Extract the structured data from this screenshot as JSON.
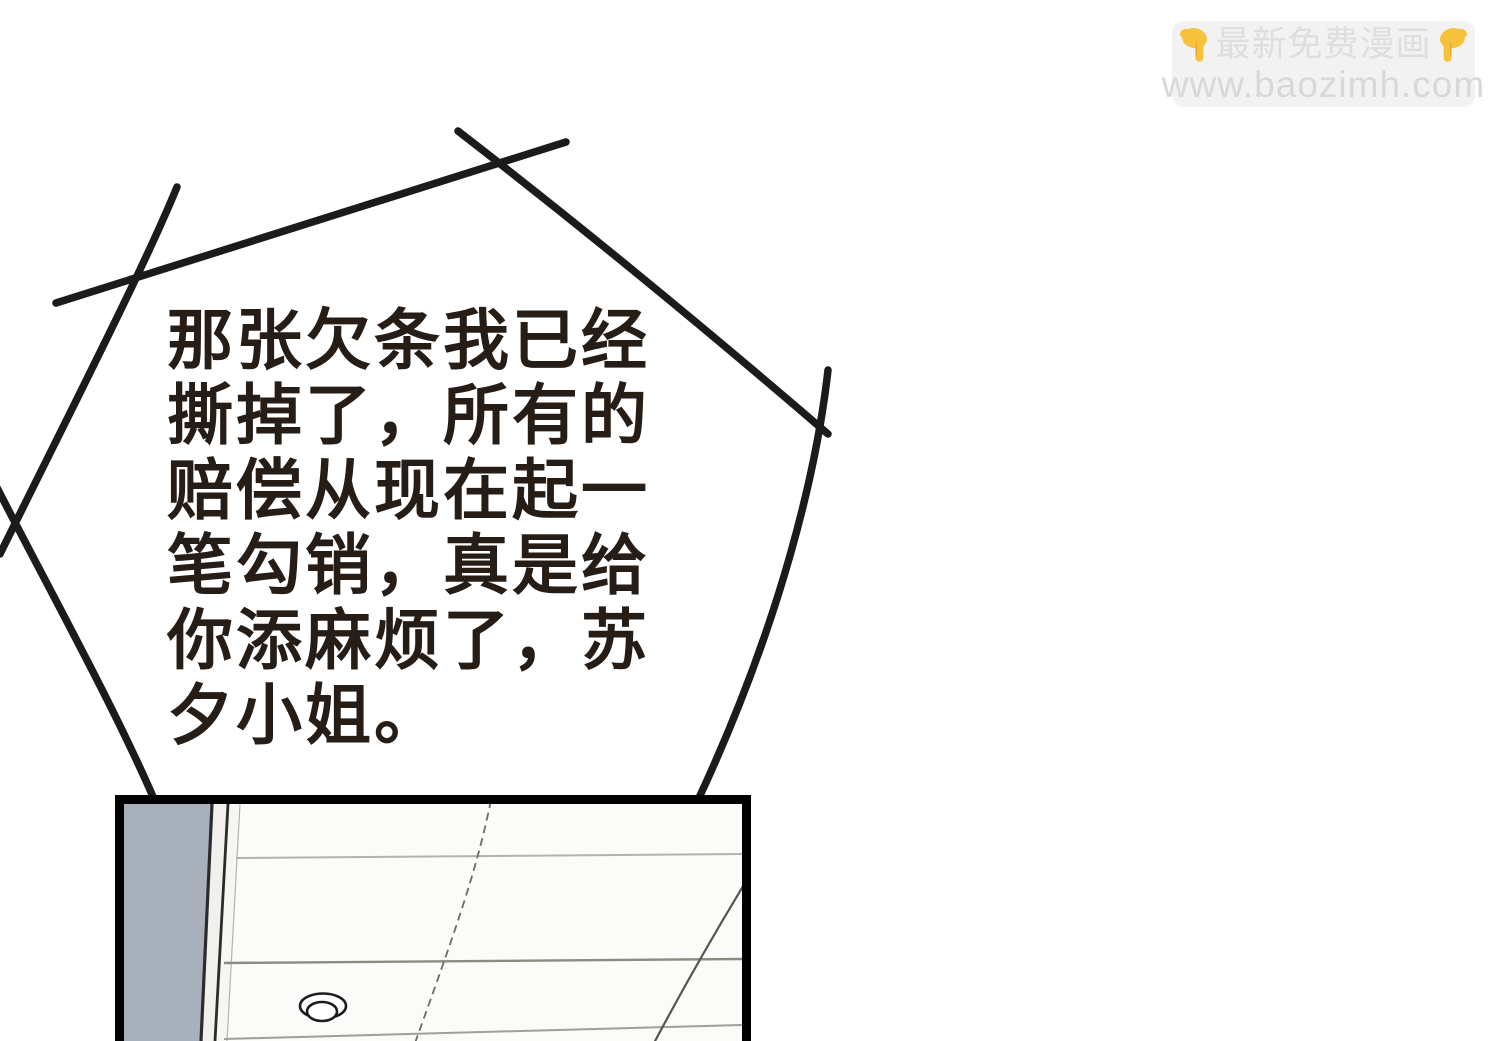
{
  "colors": {
    "page_bg": "#ffffff",
    "ink": "#1b1b1b",
    "speech_text": "#261d17",
    "watermark_bg": "#f2f2f2",
    "watermark_text": "#dedede",
    "watermark_url": "#d8d8d8",
    "hand_yellow": "#f6c23c",
    "hand_shade": "#dd9e2e",
    "wall_gray": "#a8b0bb",
    "trim_white": "#f1f0ec",
    "ceiling_white": "#fbfbfa",
    "seam_light": "#b2b2ae",
    "seam_dark": "#8b8b82",
    "panel_border": "#000000"
  },
  "watermark": {
    "title": "最新免费漫画",
    "url": "www.baozimh.com",
    "left_icon": "down-pointing-hand",
    "right_icon": "down-pointing-hand"
  },
  "speech_bubble": {
    "lines": [
      "那张欠条我已经",
      "撕掉了，所有的",
      "赔偿从现在起一",
      "笔勾销，真是给",
      "你添麻烦了，苏",
      "夕小姐。"
    ],
    "full_text": "那张欠条我已经撕掉了，所有的赔偿从现在起一笔勾销，真是给你添麻烦了，苏夕小姐。"
  }
}
